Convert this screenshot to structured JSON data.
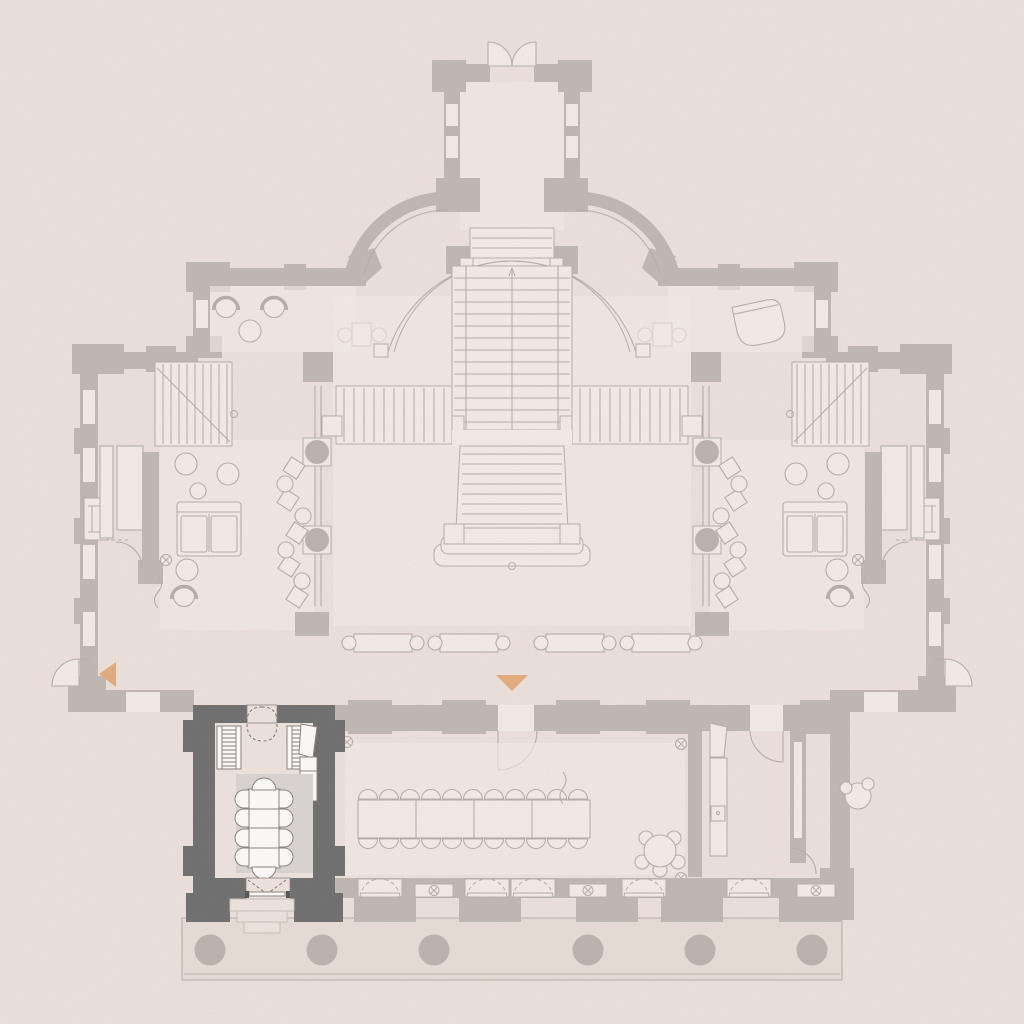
{
  "scene": {
    "kind": "architectural floor plan, piano nobile of a symmetric classical villa",
    "style": "most of the plan is washed out / faded; one room is highlighted in dark gray",
    "highlighted_room": {
      "description": "small dining room at the south-west corner, dark walls",
      "dining_table_segments": 4,
      "side_chairs": 8,
      "head_chairs": 2,
      "hatched_cabinets": 2,
      "wall_counter": 1,
      "rug": 1,
      "north_double_door": "dashed swing",
      "south_double_door": "leads over 3 steps to the terrace"
    },
    "faded_plan": {
      "north_vestibule": "projecting entry with outward double-door swing",
      "curved_quadrant_walls": 2,
      "grand_staircase": {
        "upper_flight": 1,
        "side_flights": 2,
        "lower_flight": 1,
        "curved_balcony_arc": true
      },
      "west_lounge": {
        "sofa": 1,
        "round_tables_poufs": 5,
        "corner_stair": 1,
        "fireplace": 1
      },
      "east_lounge": {
        "sofa": 1,
        "grand_piano": 1,
        "corner_stair": 1
      },
      "shoulder_tub_chairs": 2,
      "banquet_table": {
        "segments": 4,
        "chairs_top": 11,
        "chairs_bottom": 11
      },
      "round_flower_table_seats": 5,
      "terrace_columns": 6,
      "south_facade_door_bays": 5,
      "south_facade_window_symbols": 3,
      "circled_x_symbols": 8
    },
    "markers": [
      {
        "id": "west-marker",
        "shape": "triangle pointing left"
      },
      {
        "id": "south-marker",
        "shape": "triangle pointing down"
      }
    ]
  },
  "colors": {
    "bg": "#ebe0da",
    "fadedWall": "#bfb7b2",
    "fadedLine": "#b7aeaa",
    "fadedFloor": "#f2ebe5",
    "fadedCol": "#bcb3ae",
    "terrace": "#e7dcd5",
    "highlight_wall": "#6f6f6f",
    "furnWhite": "#fcfaf8",
    "furnStroke": "#8c847f",
    "roomFloor": "#ede2dc",
    "roomMat": "#d9d4d1",
    "accent": "#e3ab7e"
  }
}
